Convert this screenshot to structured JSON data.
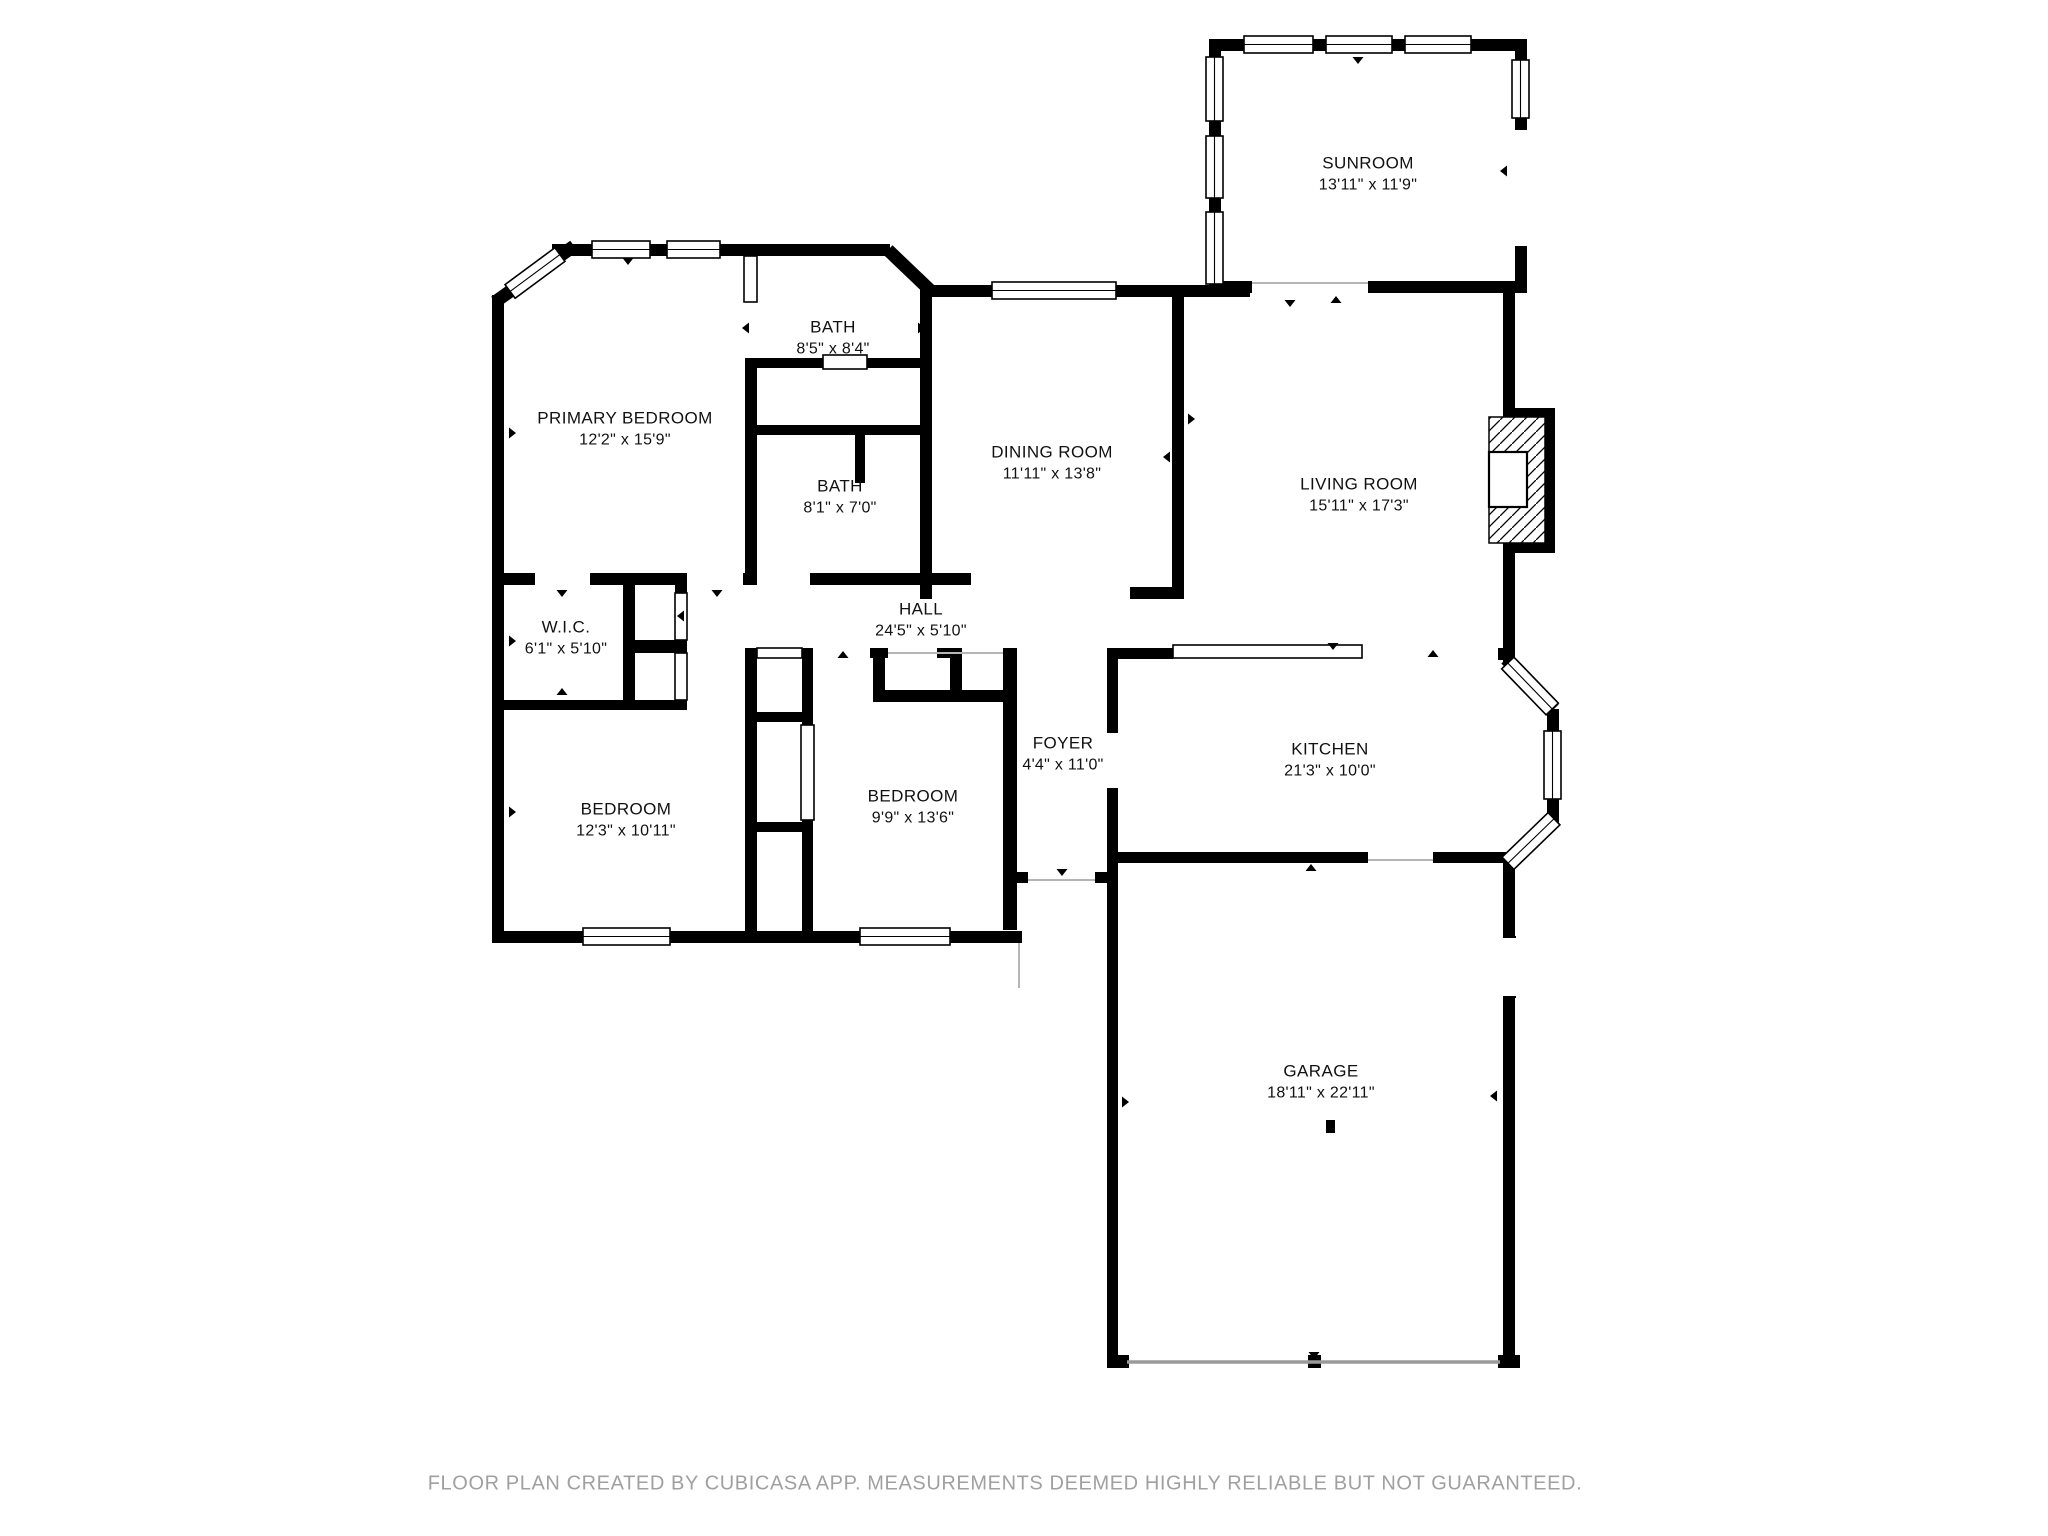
{
  "page": {
    "background_color": "#ffffff",
    "wall_color": "#000000",
    "label_text_color": "#111111",
    "footer_text_color": "#a0a0a0"
  },
  "footer": {
    "text": "FLOOR PLAN CREATED BY CUBICASA APP. MEASUREMENTS DEEMED HIGHLY RELIABLE BUT NOT GUARANTEED."
  },
  "rooms": {
    "sunroom": {
      "name": "SUNROOM",
      "dims": "13'11\" x 11'9\""
    },
    "primary_bedroom": {
      "name": "PRIMARY BEDROOM",
      "dims": "12'2\" x 15'9\""
    },
    "bath_upper": {
      "name": "BATH",
      "dims": "8'5\" x 8'4\""
    },
    "bath_lower": {
      "name": "BATH",
      "dims": "8'1\" x 7'0\""
    },
    "dining_room": {
      "name": "DINING ROOM",
      "dims": "11'11\" x 13'8\""
    },
    "living_room": {
      "name": "LIVING ROOM",
      "dims": "15'11\" x 17'3\""
    },
    "wic": {
      "name": "W.I.C.",
      "dims": "6'1\" x 5'10\""
    },
    "hall": {
      "name": "HALL",
      "dims": "24'5\" x 5'10\""
    },
    "bedroom_left": {
      "name": "BEDROOM",
      "dims": "12'3\" x 10'11\""
    },
    "bedroom_middle": {
      "name": "BEDROOM",
      "dims": "9'9\" x 13'6\""
    },
    "foyer": {
      "name": "FOYER",
      "dims": "4'4\" x 11'0\""
    },
    "kitchen": {
      "name": "KITCHEN",
      "dims": "21'3\" x 10'0\""
    },
    "garage": {
      "name": "GARAGE",
      "dims": "18'11\" x 22'11\""
    }
  }
}
